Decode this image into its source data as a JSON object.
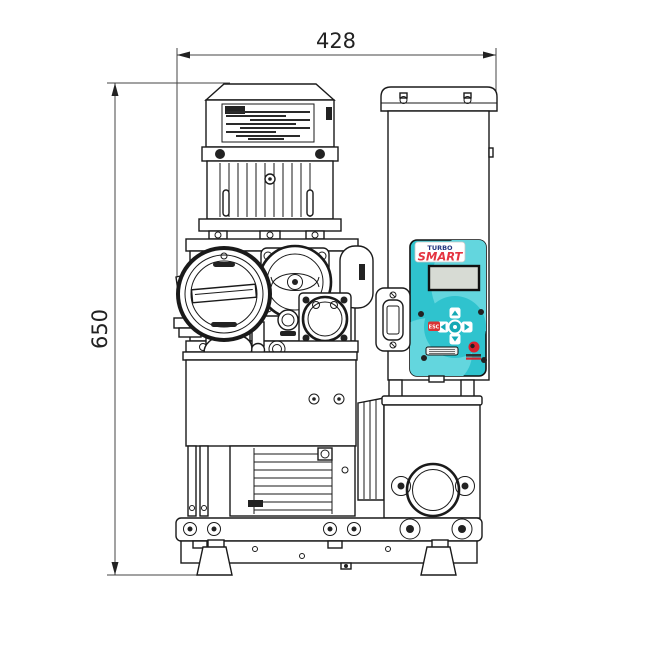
{
  "dims": {
    "width": "428",
    "height": "650"
  },
  "panel": {
    "brand_top": "TURBO",
    "brand_bottom": "SMART",
    "esc": "ESC"
  },
  "colors": {
    "line": "#1a1a1a",
    "panel_teal": "#2fc3ce",
    "panel_teal_light": "#63d6de",
    "keypad_teal": "#14a9b5",
    "brand_navy": "#23357f",
    "brand_red": "#e43440",
    "esc_red": "#d93334",
    "display_gray": "#d7dbd4",
    "logo_red": "#d9232e"
  }
}
